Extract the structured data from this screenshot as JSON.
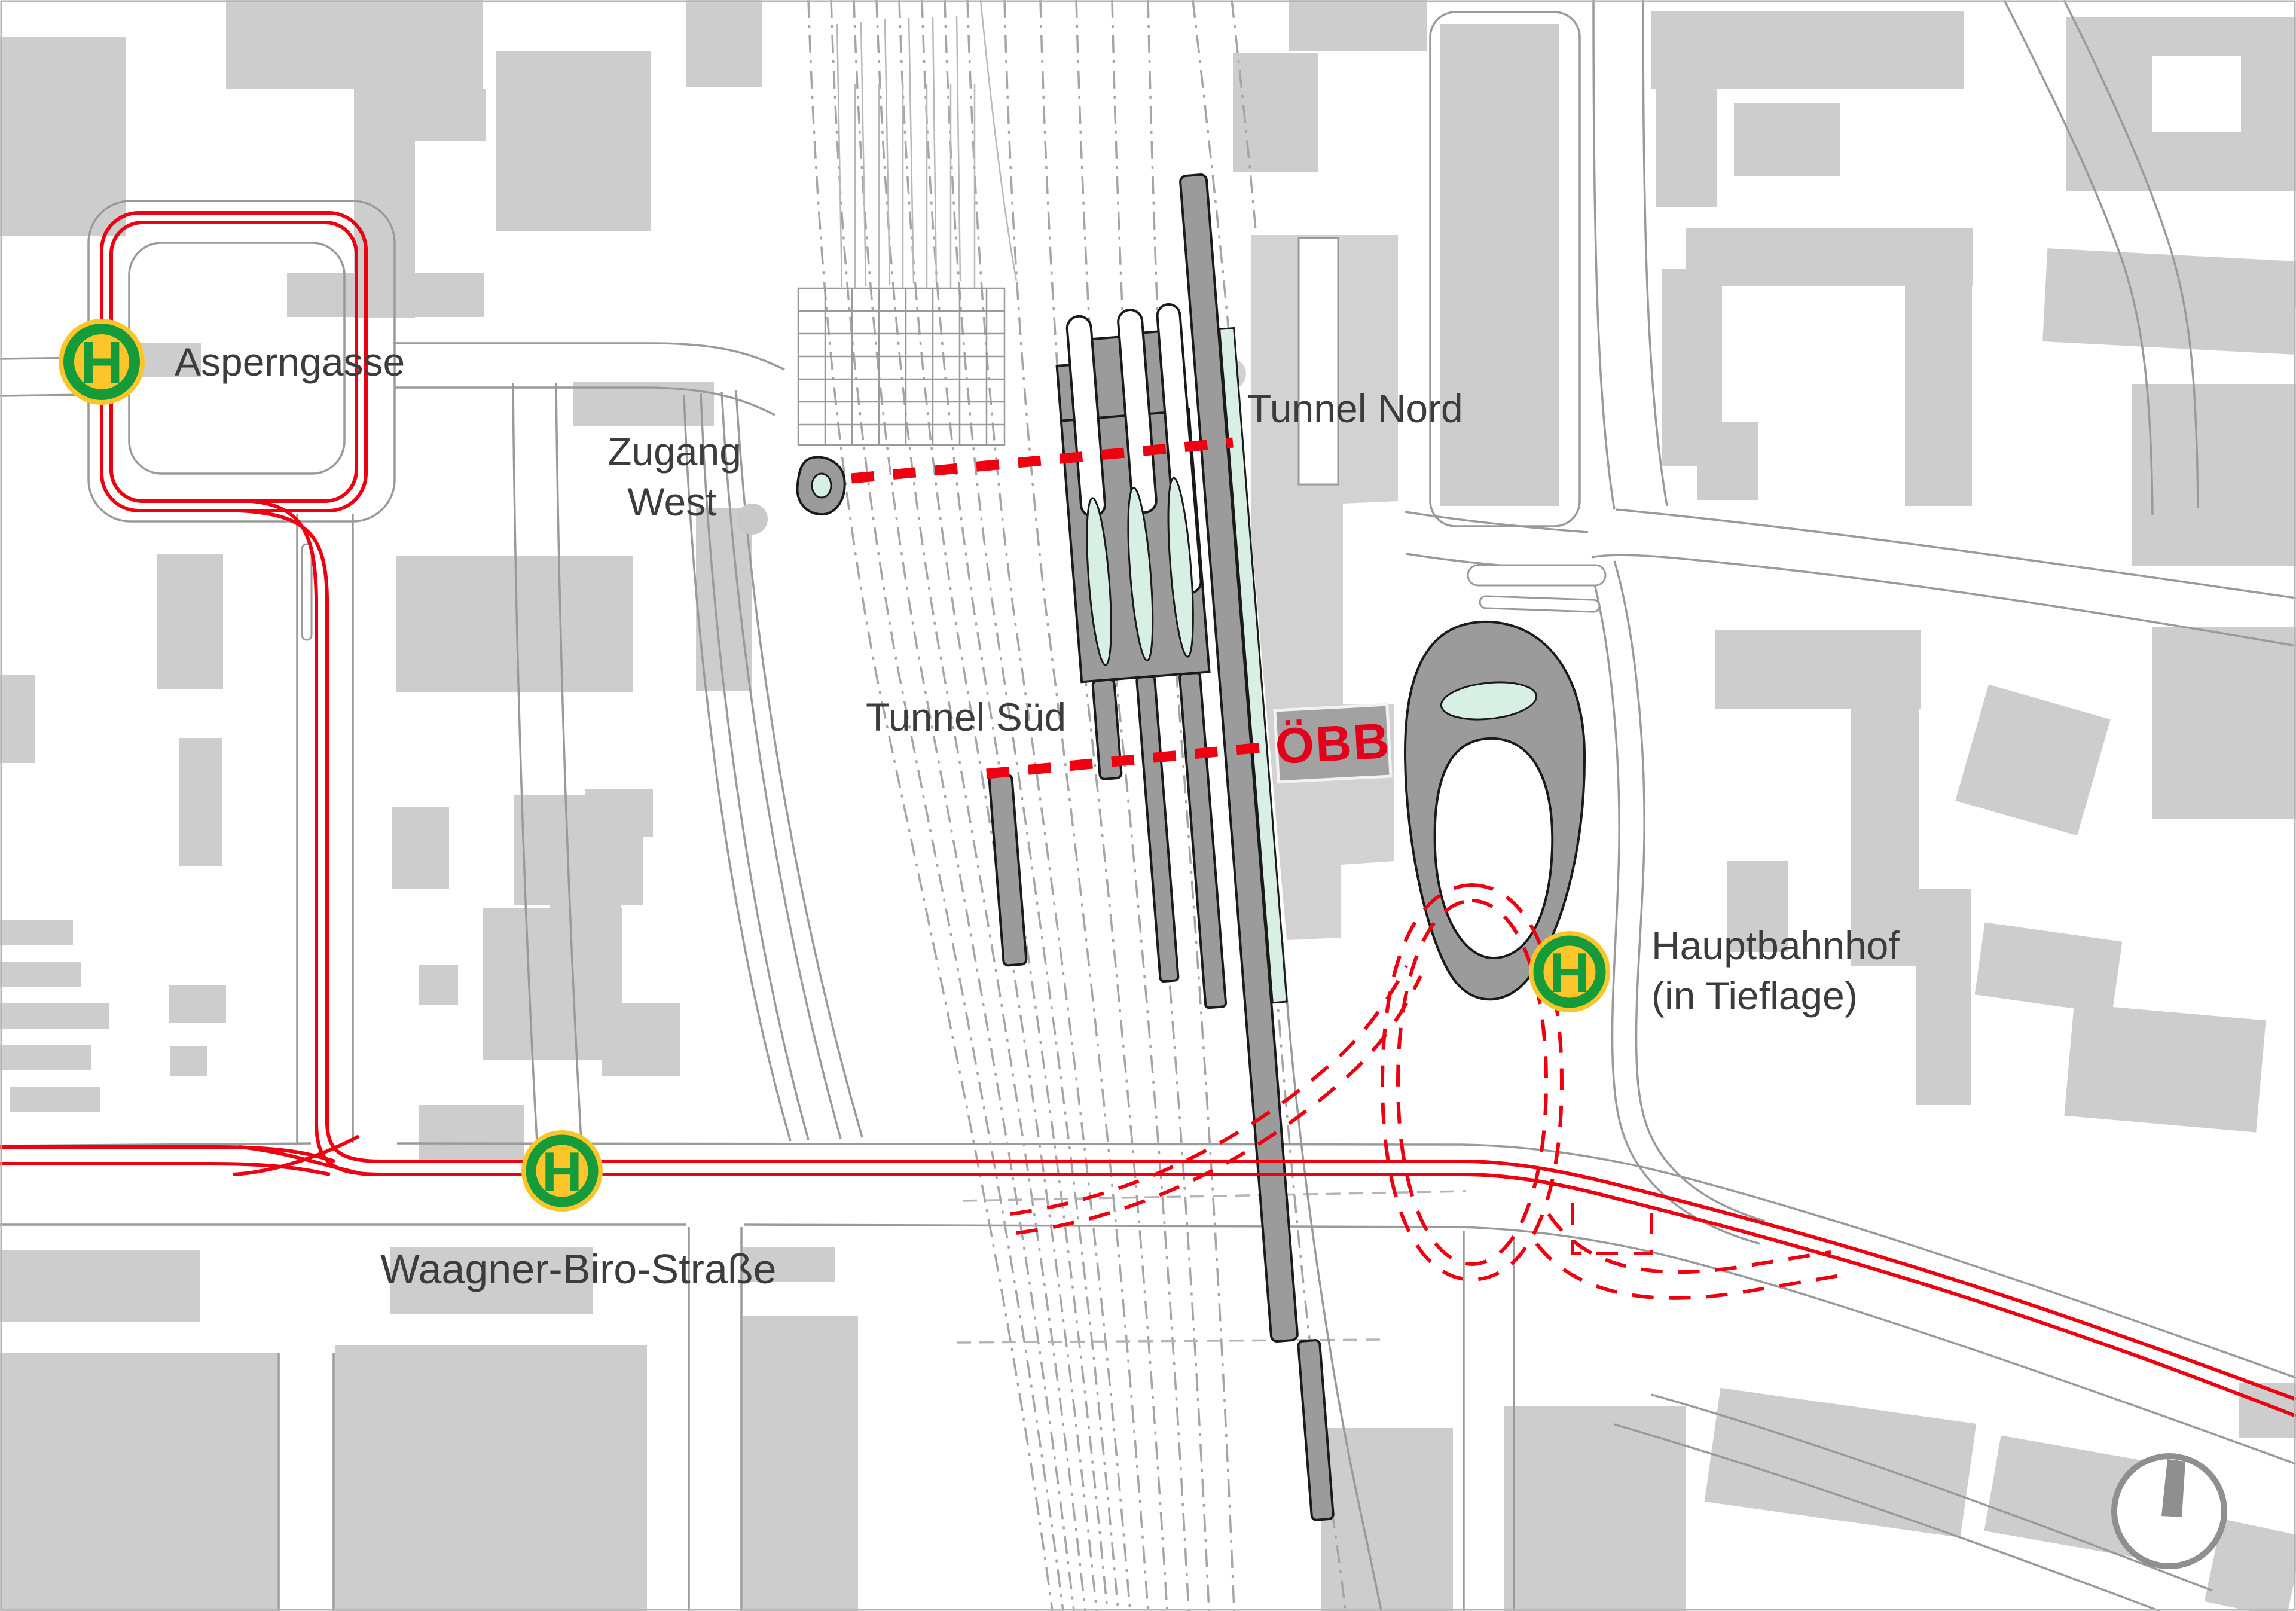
{
  "map": {
    "stops": [
      {
        "id": "asperngasse",
        "symbol": "H",
        "label": "Asperngasse"
      },
      {
        "id": "waagner-biro-strasse",
        "symbol": "H",
        "label": "Waagner-Biro-Straße"
      },
      {
        "id": "hauptbahnhof",
        "symbol": "H",
        "label": "Hauptbahnhof",
        "sublabel": "(in Tieflage)"
      }
    ],
    "region_labels": {
      "zugang_west_line1": "Zugang",
      "zugang_west_line2": "West",
      "tunnel_nord": "Tunnel Nord",
      "tunnel_sued": "Tunnel Süd"
    },
    "logos": {
      "obb": "ÖBB"
    },
    "icons": {
      "h_stop": "H-in-green-yellow-roundel",
      "north_arrow": "circle-with-needle"
    },
    "colors": {
      "tram_red": "#ee0011",
      "obb_red": "#e2001a",
      "stop_green": "#169b3b",
      "stop_yellow": "#fcc62a",
      "platform_gray": "#9b9b9b",
      "building_gray": "#cdcdcd",
      "station_gray": "#d2d2d2",
      "mint_green": "#d8efe3",
      "street_gray": "#9a9a9a",
      "label_gray": "#3c3c3c"
    }
  }
}
